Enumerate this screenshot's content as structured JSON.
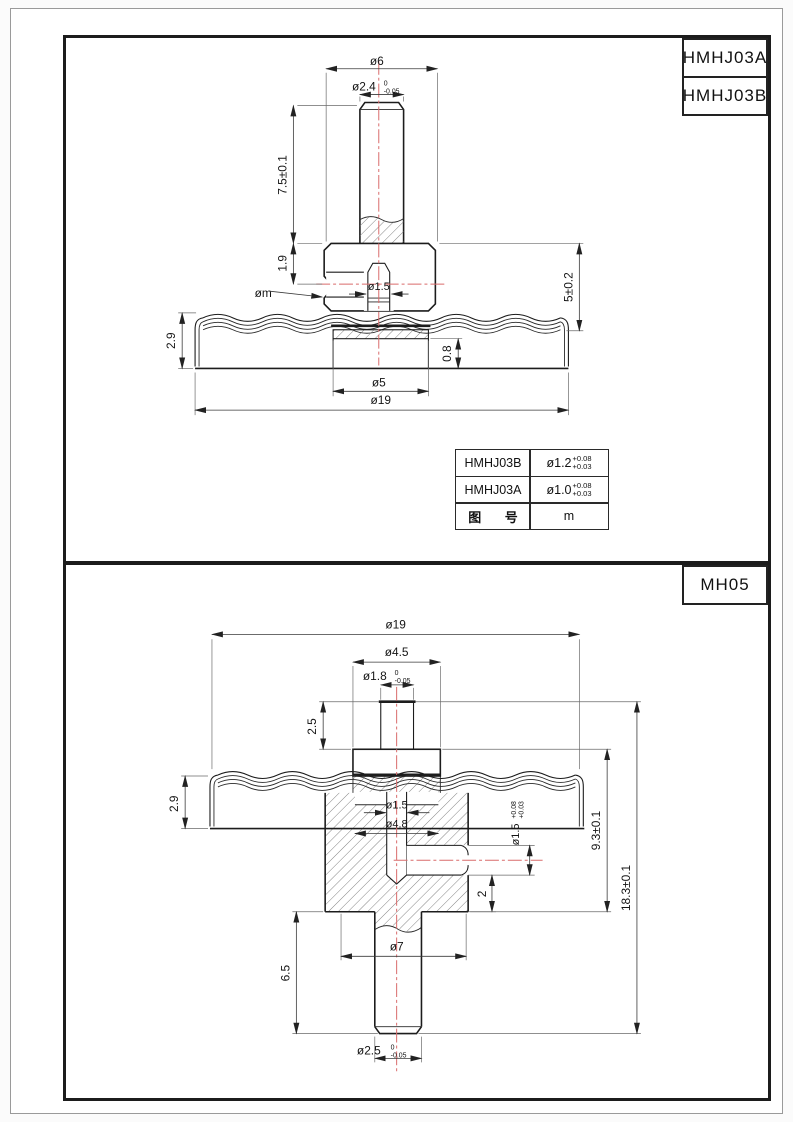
{
  "sheet": {
    "colors": {
      "centerline": "#d96b6b",
      "line": "#1c1c1c"
    },
    "top_section": {
      "title_cells": [
        "HMHJ03A",
        "HMHJ03B"
      ],
      "dims": {
        "dia6": "ø6",
        "dia24": "ø2.4",
        "dia24_sup": "0",
        "dia24_sub": "-0.05",
        "h75": "7.5±0.1",
        "h19": "1.9",
        "dia_m": "øm",
        "dia15": "ø1.5",
        "h5": "5±0.2",
        "h29": "2.9",
        "h08": "0.8",
        "dia5": "ø5",
        "dia19": "ø19"
      },
      "table": {
        "rows": [
          {
            "part": "HMHJ03B",
            "dim": "ø1.2",
            "tol_sup": "+0.08",
            "tol_sub": "+0.03"
          },
          {
            "part": "HMHJ03A",
            "dim": "ø1.0",
            "tol_sup": "+0.08",
            "tol_sub": "+0.03"
          },
          {
            "part": "图 号",
            "dim": "m"
          }
        ]
      }
    },
    "bottom_section": {
      "title_cells": [
        "MH05"
      ],
      "dims": {
        "dia19": "ø19",
        "dia45": "ø4.5",
        "dia18": "ø1.8",
        "dia18_sup": "0",
        "dia18_sub": "-0.05",
        "h25": "2.5",
        "h29": "2.9",
        "dia15": "ø1.5",
        "dia48": "ø4.8",
        "dia15s": "ø1.5",
        "dia15s_sup": "+0.08",
        "dia15s_sub": "+0.03",
        "h93": "9.3±0.1",
        "h183": "18.3±0.1",
        "h2": "2",
        "dia7": "ø7",
        "h65": "6.5",
        "dia25": "ø2.5",
        "dia25_sup": "0",
        "dia25_sub": "-0.05"
      }
    }
  }
}
